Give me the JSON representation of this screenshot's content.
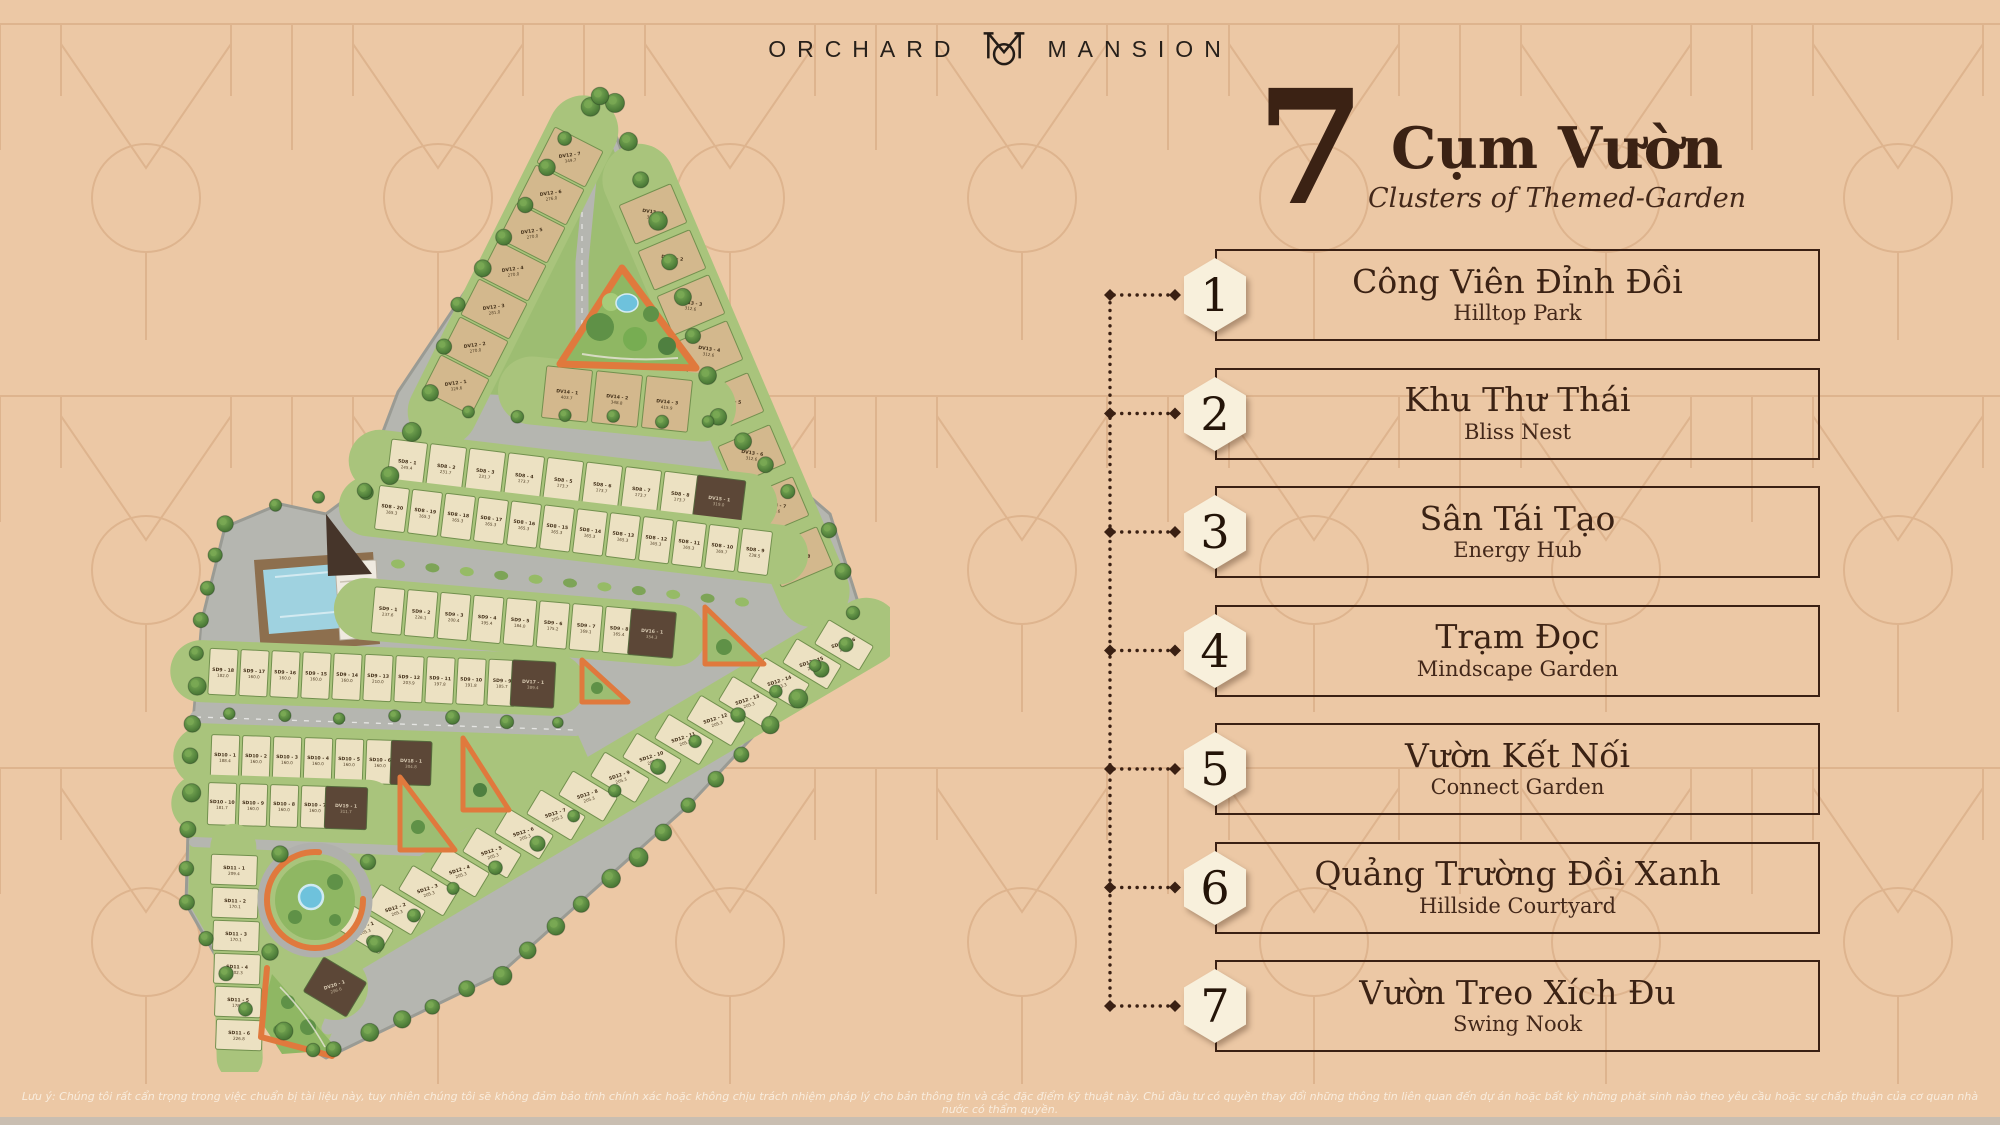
{
  "page": {
    "background": "#ecc8a5",
    "pattern_color": "#c9976d",
    "bottom_bar_color": "#c9beb1",
    "accent_dark": "#3a2013"
  },
  "logo": {
    "word_left": "ORCHARD",
    "word_right": "MANSION",
    "monogram_icon": "om-monogram"
  },
  "heading": {
    "number": "7",
    "title": "Cụm Vườn",
    "subtitle": "Clusters of Themed-Garden"
  },
  "legend": {
    "hexagon_fill": "#f8f0dc",
    "items": [
      {
        "num": "1",
        "vi": "Công Viên Đỉnh Đồi",
        "en": "Hilltop Park"
      },
      {
        "num": "2",
        "vi": "Khu Thư Thái",
        "en": "Bliss Nest"
      },
      {
        "num": "3",
        "vi": "Sân Tái Tạo",
        "en": "Energy Hub"
      },
      {
        "num": "4",
        "vi": "Trạm Đọc",
        "en": "Mindscape Garden"
      },
      {
        "num": "5",
        "vi": "Vườn Kết Nối",
        "en": "Connect Garden"
      },
      {
        "num": "6",
        "vi": "Quảng Trường Đồi Xanh",
        "en": "Hillside Courtyard"
      },
      {
        "num": "7",
        "vi": "Vườn Treo Xích Đu",
        "en": "Swing Nook"
      }
    ]
  },
  "map": {
    "accent_orange": "#e0793d",
    "rows": {
      "DV12": [
        [
          "DV12 - 7",
          "349.7"
        ],
        [
          "DV12 - 6",
          "276.0"
        ],
        [
          "DV12 - 5",
          "270.0"
        ],
        [
          "DV12 - 4",
          "270.0"
        ],
        [
          "DV12 - 3",
          "281.0"
        ],
        [
          "DV12 - 2",
          "270.0"
        ],
        [
          "DV12 - 1",
          "329.6"
        ]
      ],
      "DV13": [
        [
          "DV13 - 1",
          "350.0"
        ],
        [
          "DV13 - 2",
          "300.9"
        ],
        [
          "DV13 - 3",
          "312.6"
        ],
        [
          "DV13 - 4",
          "312.6"
        ],
        [
          "DV13 - 5",
          "312.6"
        ],
        [
          "DV13 - 6",
          "312.6"
        ],
        [
          "DV13 - 7",
          "312.6"
        ],
        [
          "DV13 - 8",
          "420.6"
        ]
      ],
      "DV14": [
        [
          "DV14 - 1",
          "403.7"
        ],
        [
          "DV14 - 2",
          "348.8"
        ],
        [
          "DV14 - 3",
          "415.9"
        ]
      ],
      "SD8A": [
        [
          "SD8 - 1",
          "245.4"
        ],
        [
          "SD8 - 2",
          "231.7"
        ],
        [
          "SD8 - 3",
          "231.7"
        ],
        [
          "SD8 - 4",
          "173.7"
        ],
        [
          "SD8 - 5",
          "173.7"
        ],
        [
          "SD8 - 6",
          "173.7"
        ],
        [
          "SD8 - 7",
          "173.7"
        ],
        [
          "SD8 - 8",
          "173.7"
        ],
        [
          "DV15 - 1",
          "319.0",
          "d",
          1.35
        ]
      ],
      "SD8B": [
        [
          "SD8 - 20",
          "165.3"
        ],
        [
          "SD8 - 19",
          "165.3"
        ],
        [
          "SD8 - 18",
          "165.3"
        ],
        [
          "SD8 - 17",
          "165.3"
        ],
        [
          "SD8 - 16",
          "165.3"
        ],
        [
          "SD8 - 15",
          "165.3"
        ],
        [
          "SD8 - 14",
          "165.3"
        ],
        [
          "SD8 - 13",
          "165.3"
        ],
        [
          "SD8 - 12",
          "165.3"
        ],
        [
          "SD8 - 11",
          "165.3"
        ],
        [
          "SD8 - 10",
          "165.7"
        ],
        [
          "SD8 - 9",
          "238.5"
        ]
      ],
      "SD9A": [
        [
          "SD9 - 1",
          "237.6"
        ],
        [
          "SD9 - 2",
          "226.1"
        ],
        [
          "SD9 - 3",
          "200.4"
        ],
        [
          "SD9 - 4",
          "195.4"
        ],
        [
          "SD9 - 5",
          "184.0"
        ],
        [
          "SD9 - 6",
          "175.2"
        ],
        [
          "SD9 - 7",
          "169.1"
        ],
        [
          "SD9 - 8",
          "165.4"
        ],
        [
          "DV16 - 1",
          "354.3",
          "d",
          1.5
        ]
      ],
      "SD9B": [
        [
          "SD9 - 18",
          "182.0"
        ],
        [
          "SD9 - 17",
          "160.0"
        ],
        [
          "SD9 - 16",
          "160.0"
        ],
        [
          "SD9 - 15",
          "160.0"
        ],
        [
          "SD9 - 14",
          "160.0"
        ],
        [
          "SD9 - 13",
          "210.0"
        ],
        [
          "SD9 - 12",
          "203.9"
        ],
        [
          "SD9 - 11",
          "197.8"
        ],
        [
          "SD9 - 10",
          "191.8"
        ],
        [
          "SD9 - 9",
          "185.7"
        ],
        [
          "DV17 - 1",
          "389.4",
          "d",
          1.55
        ]
      ],
      "SD10A": [
        [
          "SD10 - 1",
          "188.4"
        ],
        [
          "SD10 - 2",
          "160.0"
        ],
        [
          "SD10 - 3",
          "160.0"
        ],
        [
          "SD10 - 4",
          "160.0"
        ],
        [
          "SD10 - 5",
          "160.0"
        ],
        [
          "SD10 - 6",
          "160.0"
        ],
        [
          "DV18 - 1",
          "304.8",
          "d",
          1.45
        ]
      ],
      "SD10B": [
        [
          "SD10 - 10",
          "181.7"
        ],
        [
          "SD10 - 9",
          "160.0"
        ],
        [
          "SD10 - 8",
          "160.0"
        ],
        [
          "SD10 - 7",
          "160.0"
        ],
        [
          "DV19 - 1",
          "311.7",
          "d",
          1.5
        ]
      ],
      "SD11": [
        [
          "SD11 - 1",
          "209.4"
        ],
        [
          "SD11 - 2",
          "170.1"
        ],
        [
          "SD11 - 3",
          "170.1"
        ],
        [
          "SD11 - 4",
          "202.3"
        ],
        [
          "SD11 - 5",
          "178.2"
        ],
        [
          "SD11 - 6",
          "226.8"
        ]
      ],
      "SD12": [
        [
          "SD12 - 16",
          "229.6"
        ],
        [
          "SD12 - 15",
          "221.3"
        ],
        [
          "SD12 - 14",
          "223.3"
        ],
        [
          "SD12 - 13",
          "205.3"
        ],
        [
          "SD12 - 12",
          "205.3"
        ],
        [
          "SD12 - 11",
          "205.3"
        ],
        [
          "SD12 - 10",
          "205.3"
        ],
        [
          "SD12 - 9",
          "205.3"
        ],
        [
          "SD12 - 8",
          "205.3"
        ],
        [
          "SD12 - 7",
          "205.3"
        ],
        [
          "SD12 - 6",
          "205.3"
        ],
        [
          "SD12 - 5",
          "205.3"
        ],
        [
          "SD12 - 4",
          "205.3"
        ],
        [
          "SD12 - 3",
          "205.3"
        ],
        [
          "SD12 - 2",
          "205.3"
        ],
        [
          "SD12 - 1",
          "205.3"
        ]
      ],
      "DV20": [
        [
          "DV20 - 1",
          "296.6",
          "d"
        ]
      ]
    }
  },
  "disclaimer": "Lưu ý: Chúng tôi rất cẩn trọng trong việc chuẩn bị tài liệu này, tuy nhiên chúng tôi sẽ không đảm bảo tính chính xác hoặc không chịu trách nhiệm pháp lý cho bản thông tin và các đặc điểm kỹ thuật này. Chủ đầu tư có quyền thay đổi những thông tin liên quan đến dự án hoặc bất kỳ những phát sinh nào theo yêu cầu hoặc sự chấp thuận của cơ quan nhà nước có thẩm quyền."
}
